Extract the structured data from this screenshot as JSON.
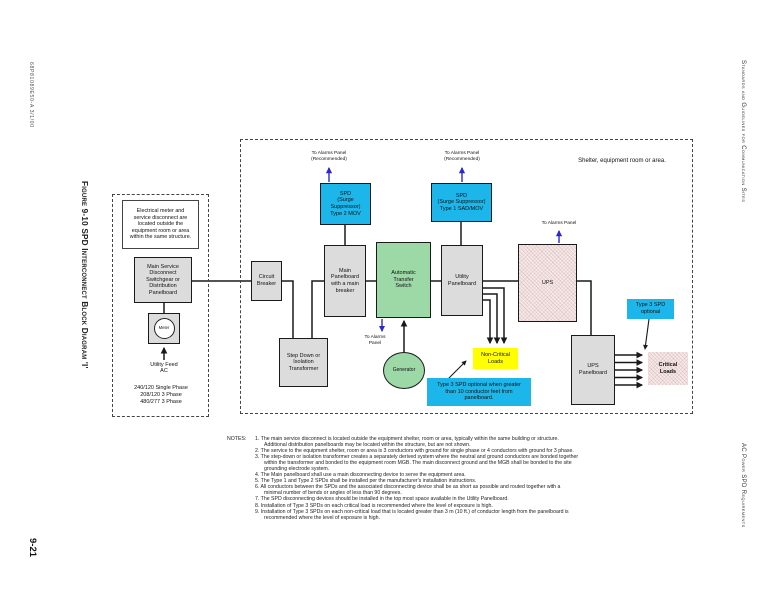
{
  "page": {
    "doc_number": "68P81089E50-A    3/1/00",
    "figure_caption": "Figure 9-10   SPD Interconnect Block Diagram 'I'",
    "page_number": "9-21",
    "header_right": "Standards and Guidelines for Communication Sites",
    "footer_right": "AC Power SPD Requirements"
  },
  "diagram": {
    "shelter_label": "Shelter, equipment room or area.",
    "outside_note": "Electrical meter and\nservice disconnect are\nlocated outside the\nequipment room or area\nwithin the same structure.",
    "main_service_disconnect": "Main Service\nDisconnect\nSwitchgear or\nDistribution\nPanelboard",
    "meter": "Meter",
    "utility_feed": "Utility Feed\nAC",
    "phases": "240/120 Single Phase\n208/120  3 Phase\n480/277  3 Phase",
    "circuit_breaker": "Circuit\nBreaker",
    "main_panelboard": "Main\nPanelboard\nwith a main\nbreaker",
    "ats": "Automatic\nTransfer\nSwitch",
    "utility_panelboard": "Utility\nPanelboard",
    "ups": "UPS",
    "ups_panelboard": "UPS\nPanelboard",
    "transformer": "Step Down or\nIsolation\nTransformer",
    "generator": "Generator",
    "spd_type2": "SPD\n(Surge\nSuppressor)\nType 2 MOV",
    "spd_type1": "SPD\n(Surge Suppressor)\nType 1  SAD/MOV",
    "alarm_recommended": "To Alarms Panel\n(Recommended)",
    "alarm_panel": "To Alarms Panel",
    "ats_alarm": "To Alarms\nPanel",
    "non_critical_loads": "Non-Critical\nLoads",
    "critical_loads": "Critical\nLoads",
    "type3_note": "Type 3 SPD optional when greater\nthan 10 conductor feet from\npanelboard.",
    "type3_optional": "Type 3 SPD\noptional"
  },
  "colors": {
    "spd_cyan": "#1db6ea",
    "ats_green": "#9dd8a7",
    "loads_yellow": "#ffff00",
    "ups_pink": "#f6eaea",
    "box_gray": "#dcdcdc",
    "alarm_blue": "#2a2acc"
  },
  "notes": {
    "heading": "NOTES:",
    "items": [
      "1.  The main service disconnect is located outside the equipment shelter, room or area, typically within the same building or structure.  Additional distribution panelboards may be located within the structure, but are not shown.",
      "2.  The service to the equipment shelter, room or area is 3 conductors with ground for single phase or 4 conductors with ground for 3 phase.",
      "3.  The step-down or isolation transformer creates a separately derived system where the neutral and ground conductors are bonded together within the transformer and bonded to the equipment room MGB.  The main disconnect ground and the MGB shall be bonded to the site grounding electrode system.",
      "4.  The Main panelboard shall use a main disconnecting device to serve the equipment area.",
      "5.  The Type 1 and Type 2 SPDs shall be installed per the manufacturer's installation instructions.",
      "6.  All conductors between the SPDs and the associated disconnecting device shall be as short as possible and routed together with a minimal number of bends or angles of less than 90 degrees.",
      "7.  The SPD disconnecting devices should be installed in the top most space available in the Utility Panelboard.",
      "8.  Installation of Type 3 SPDs on each critical load is recommended where the level of exposure is high.",
      "9.  Installation of Type 3 SPDs on each non-critical load that is located greater than 3 m (10 ft.) of conductor length from the panelboard is recommended where the level of exposure is high."
    ]
  }
}
